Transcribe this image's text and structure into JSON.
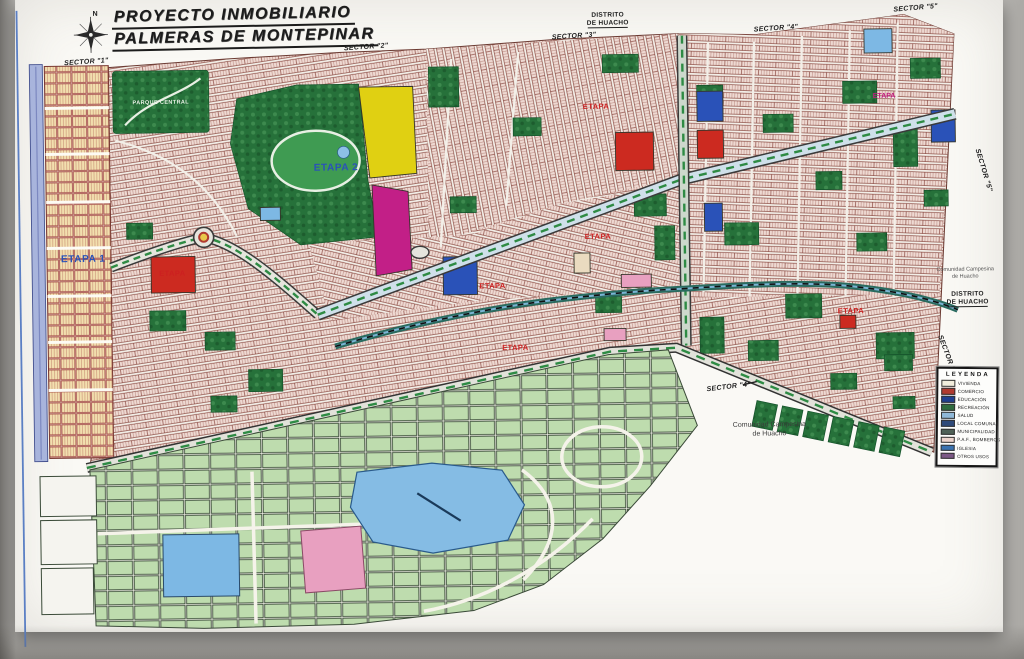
{
  "title": {
    "line1": "PROYECTO INMOBILIARIO",
    "line2": "PALMERAS DE MONTEPINAR"
  },
  "compass": {
    "north_label": "N"
  },
  "district_top": {
    "line1": "DISTRITO",
    "line2": "DE HUACHO"
  },
  "district_right": {
    "line1": "DISTRITO",
    "line2": "DE HUACHO"
  },
  "comunidad_right": {
    "line1": "Comunidad Campesina",
    "line2": "de Huacho"
  },
  "comunidad_bottom": {
    "line1": "Comunidad Campesina",
    "line2": "de Huacho"
  },
  "park_central_label": "PARQUE CENTRAL",
  "sectors": {
    "s1": "SECTOR \"1\"",
    "s2": "SECTOR \"2\"",
    "s3": "SECTOR \"3\"",
    "s4": "SECTOR \"4\"",
    "s5": "SECTOR \"5\"",
    "s5_rotated": "SECTOR \"5\"",
    "s5_rotated2": "SECTOR \"5\"",
    "s4_bottom": "SECTOR \"4\""
  },
  "etapas": {
    "blue1": "ETAPA 1",
    "blue2": "ETAPA 2",
    "red1": "ETAPA",
    "red2": "ETAPA",
    "red3": "ETAPA",
    "red4": "ETAPA",
    "red5": "ETAPA",
    "red6": "ETAPA",
    "magenta1": "ETAPA"
  },
  "legend": {
    "title": "LEYENDA",
    "items": [
      {
        "label": "VIVIENDA",
        "color": "#f2eedd"
      },
      {
        "label": "COMERCIO",
        "color": "#b03a30"
      },
      {
        "label": "EDUCACIÓN",
        "color": "#1f3f8f"
      },
      {
        "label": "RECREACIÓN",
        "color": "#2e6b3e"
      },
      {
        "label": "SALUD",
        "color": "#8fb8d8"
      },
      {
        "label": "LOCAL COMUNAL",
        "color": "#2e4a7a"
      },
      {
        "label": "MUNICIPALIDAD",
        "color": "#4f6157"
      },
      {
        "label": "P.A.F., BOMBEROS",
        "color": "#eed5cd"
      },
      {
        "label": "IGLESIA",
        "color": "#3a72b0"
      },
      {
        "label": "OTROS USOS",
        "color": "#7c5886"
      }
    ]
  },
  "colors": {
    "yellow": "#e0d012",
    "magenta": "#c21f87",
    "red": "#cc2a20",
    "blue": "#2a52b8",
    "skyblue": "#7db8e4",
    "pink": "#e8a0c0",
    "beige": "#eadbc0",
    "park": "#26713a",
    "lagoon": "#85bce4",
    "canal": "#2a6b5f",
    "farm": "#c2dfb4"
  }
}
